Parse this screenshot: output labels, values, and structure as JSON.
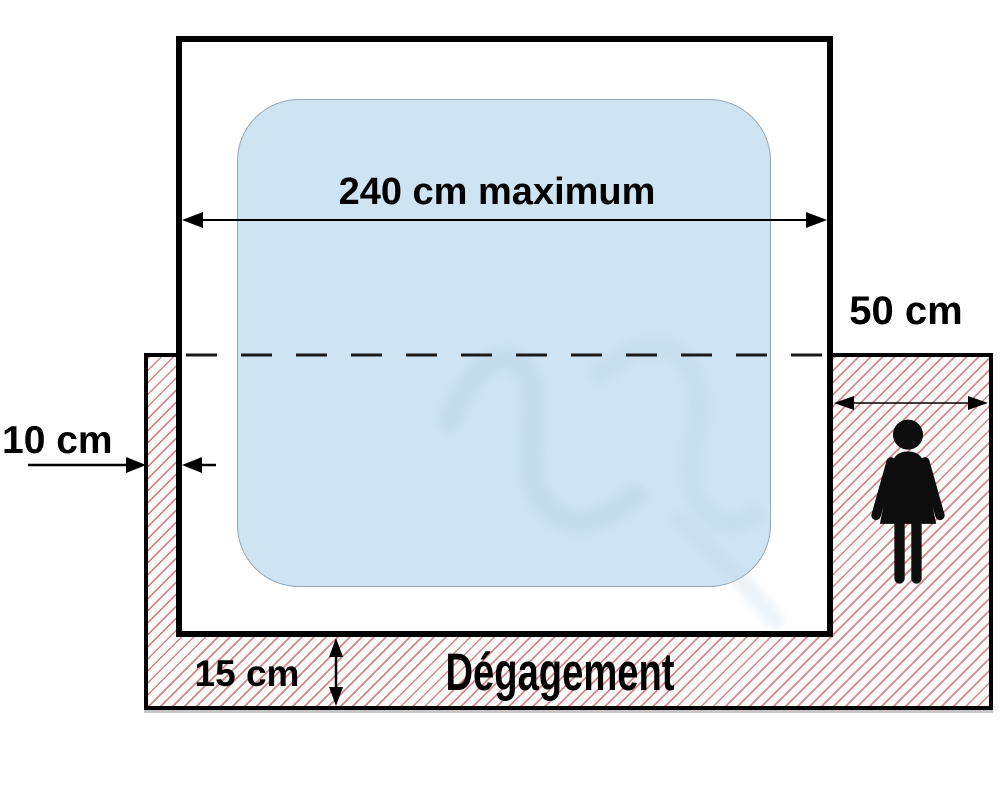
{
  "diagram": {
    "labels": {
      "max_width": "240 cm maximum",
      "side_clearance": "50 cm",
      "wall_gap": "10 cm",
      "bottom_clearance": "15 cm",
      "zone": "Dégagement"
    },
    "colors": {
      "pool_fill": "#cfe4f2",
      "pool_border": "#93a9b6",
      "hatch_line": "#d4888a",
      "outline": "#000000",
      "text": "#000000"
    },
    "icons": {
      "person": "woman-pictogram"
    }
  }
}
